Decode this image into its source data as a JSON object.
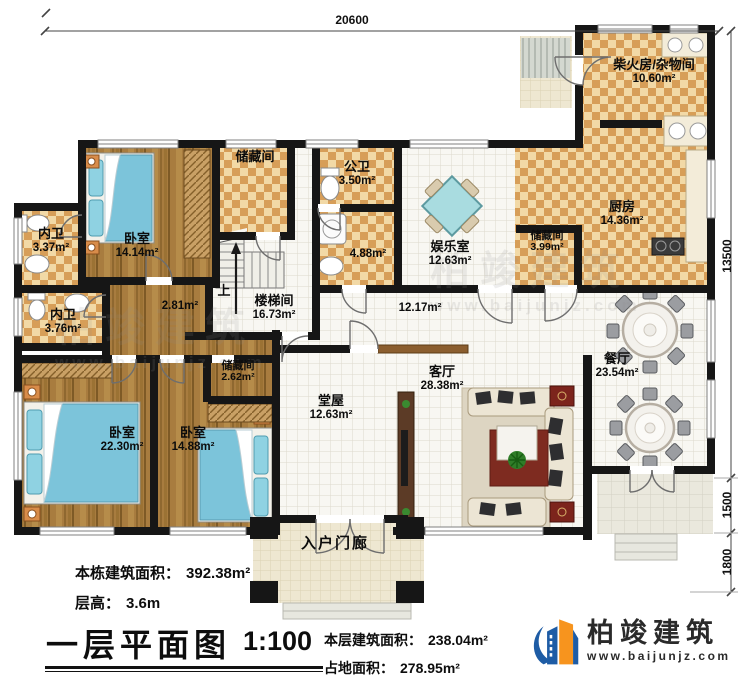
{
  "plan": {
    "dim_top": "20600",
    "dim_right_main": "13500",
    "dim_right_terrace": "1500",
    "dim_right_steps": "1800",
    "stairs_up": "上",
    "rooms": [
      {
        "name": "储藏间",
        "area": ""
      },
      {
        "name": "公卫",
        "area": "3.50m²"
      },
      {
        "name": "",
        "area": "4.88m²"
      },
      {
        "name": "娱乐室",
        "area": "12.63m²"
      },
      {
        "name": "柴火房/杂物间",
        "area": "10.60m²"
      },
      {
        "name": "厨房",
        "area": "14.36m²"
      },
      {
        "name": "储藏间",
        "area": "3.99m²"
      },
      {
        "name": "餐厅",
        "area": "23.54m²"
      },
      {
        "name": "内卫",
        "area": "3.37m²"
      },
      {
        "name": "卧室",
        "area": "14.14m²"
      },
      {
        "name": "内卫",
        "area": "3.76m²"
      },
      {
        "name": "",
        "area": "2.81m²"
      },
      {
        "name": "楼梯间",
        "area": "16.73m²"
      },
      {
        "name": "",
        "area": "12.17m²"
      },
      {
        "name": "储藏间",
        "area": "2.62m²"
      },
      {
        "name": "卧室",
        "area": "22.30m²"
      },
      {
        "name": "卧室",
        "area": "14.88m²"
      },
      {
        "name": "堂屋",
        "area": "12.63m²"
      },
      {
        "name": "客厅",
        "area": "28.38m²"
      },
      {
        "name": "入户门廊",
        "area": ""
      }
    ]
  },
  "footer": {
    "building_area_label": "本栋建筑面积：",
    "building_area_value": "392.38m²",
    "floor_height_label": "层高：",
    "floor_height_value": "3.6m",
    "title": "一层平面图",
    "scale": "1:100",
    "floor_area_label": "本层建筑面积：",
    "floor_area_value": "238.04m²",
    "footprint_label": "占地面积：",
    "footprint_value": "278.95m²"
  },
  "logo": {
    "name": "柏竣建筑",
    "url": "www.baijunjz.com"
  },
  "watermark": {
    "text": "柏竣建筑",
    "url": "www.baijunjz.com"
  },
  "colors": {
    "wall": "#161616",
    "checker_light": "#f2d9a6",
    "checker_dark": "#d79e58",
    "wood_floor": "#a87c3f",
    "bed_blue": "#7cc4da",
    "logo_blue": "#1e5ca5",
    "logo_orange": "#f7941e"
  }
}
